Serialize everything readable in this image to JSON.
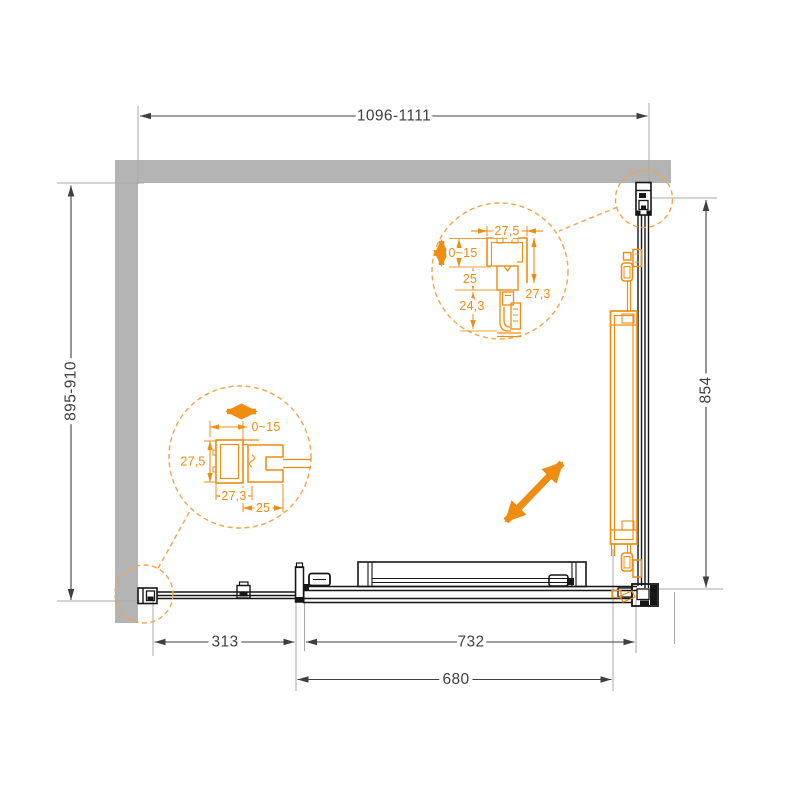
{
  "dimensions": {
    "top_width": "1096-1111",
    "left_height": "895-910",
    "right_height": "854",
    "bottom_left": "313",
    "bottom_opening": "732",
    "bottom_door": "680"
  },
  "detail_top": {
    "width": "27,5",
    "adjust": "0~15",
    "mid": "25",
    "lower": "24,3",
    "height": "27,3"
  },
  "detail_left": {
    "adjust": "0~15",
    "height": "27,5",
    "width": "27,3",
    "depth": "25"
  },
  "colors": {
    "background": "#ffffff",
    "wall": "#b4b4b4",
    "drawing": "#161616",
    "dimension_text": "#3f3f3f",
    "extension_line": "#a8a8a8",
    "accent_orange": "#ef8c12",
    "accent_dashed": "#f2a44a"
  }
}
